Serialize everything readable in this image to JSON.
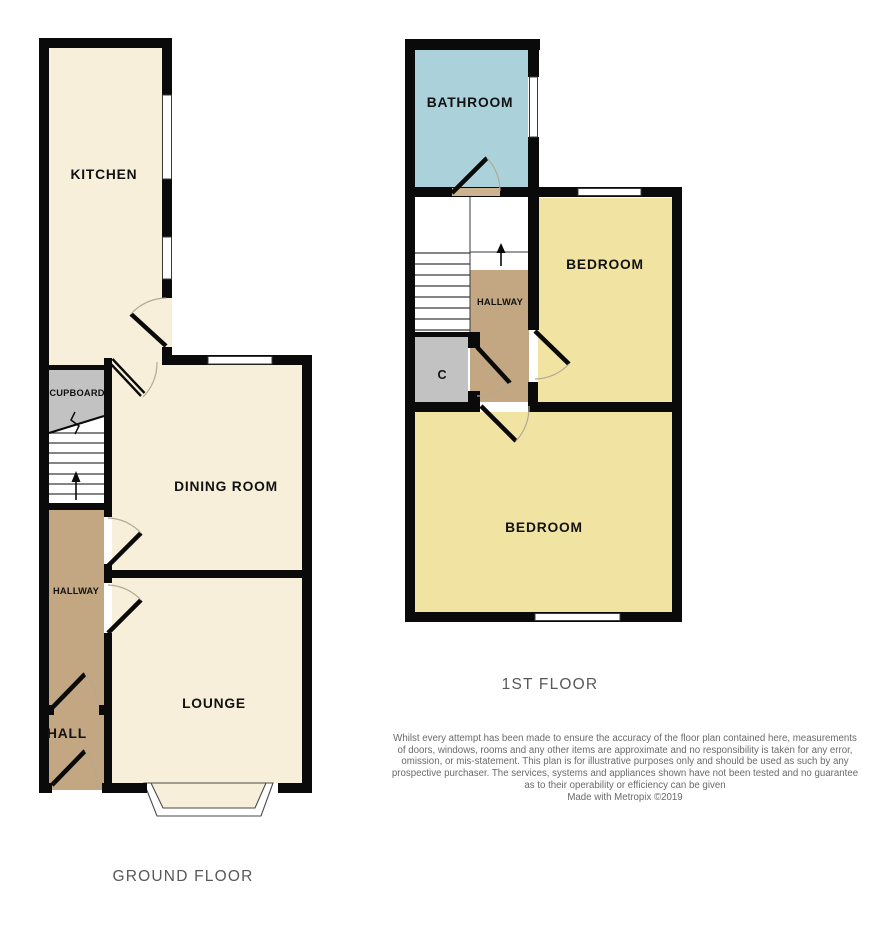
{
  "ground_floor": {
    "title": "GROUND FLOOR",
    "rooms": {
      "kitchen": "KITCHEN",
      "cupboard": "CUPBOARD",
      "dining": "DINING ROOM",
      "hallway": "HALLWAY",
      "hall": "HALL",
      "lounge": "LOUNGE"
    }
  },
  "first_floor": {
    "title": "1ST FLOOR",
    "rooms": {
      "bathroom": "BATHROOM",
      "bedroom1": "BEDROOM",
      "hallway": "HALLWAY",
      "cupboard": "C",
      "bedroom2": "BEDROOM"
    }
  },
  "disclaimer": {
    "lines": [
      "Whilst every attempt has been made to ensure the accuracy of the floor plan contained here, measurements",
      "of doors, windows, rooms and any other items are approximate and no responsibility is taken for any error,",
      "omission, or mis-statement. This plan is for illustrative purposes only and should be used as such by any",
      "prospective purchaser. The services, systems and appliances shown have not been tested and no guarantee",
      "as to their operability or efficiency can be given"
    ],
    "credit": "Made with Metropix ©2019"
  },
  "colors": {
    "wall_black": "#0a0a0a",
    "room_cream": "#f8efda",
    "room_yellow": "#f1e4a2",
    "room_blue": "#abd2db",
    "hall_brown": "#c3a782",
    "threshold_tan": "#ccb28e",
    "cupboard_grey": "#c2c2c2",
    "window_stroke": "#3a3a3a",
    "arc_grey": "#b3a893",
    "label_grey": "#585858",
    "disclaimer_grey": "#6a6a6a"
  }
}
